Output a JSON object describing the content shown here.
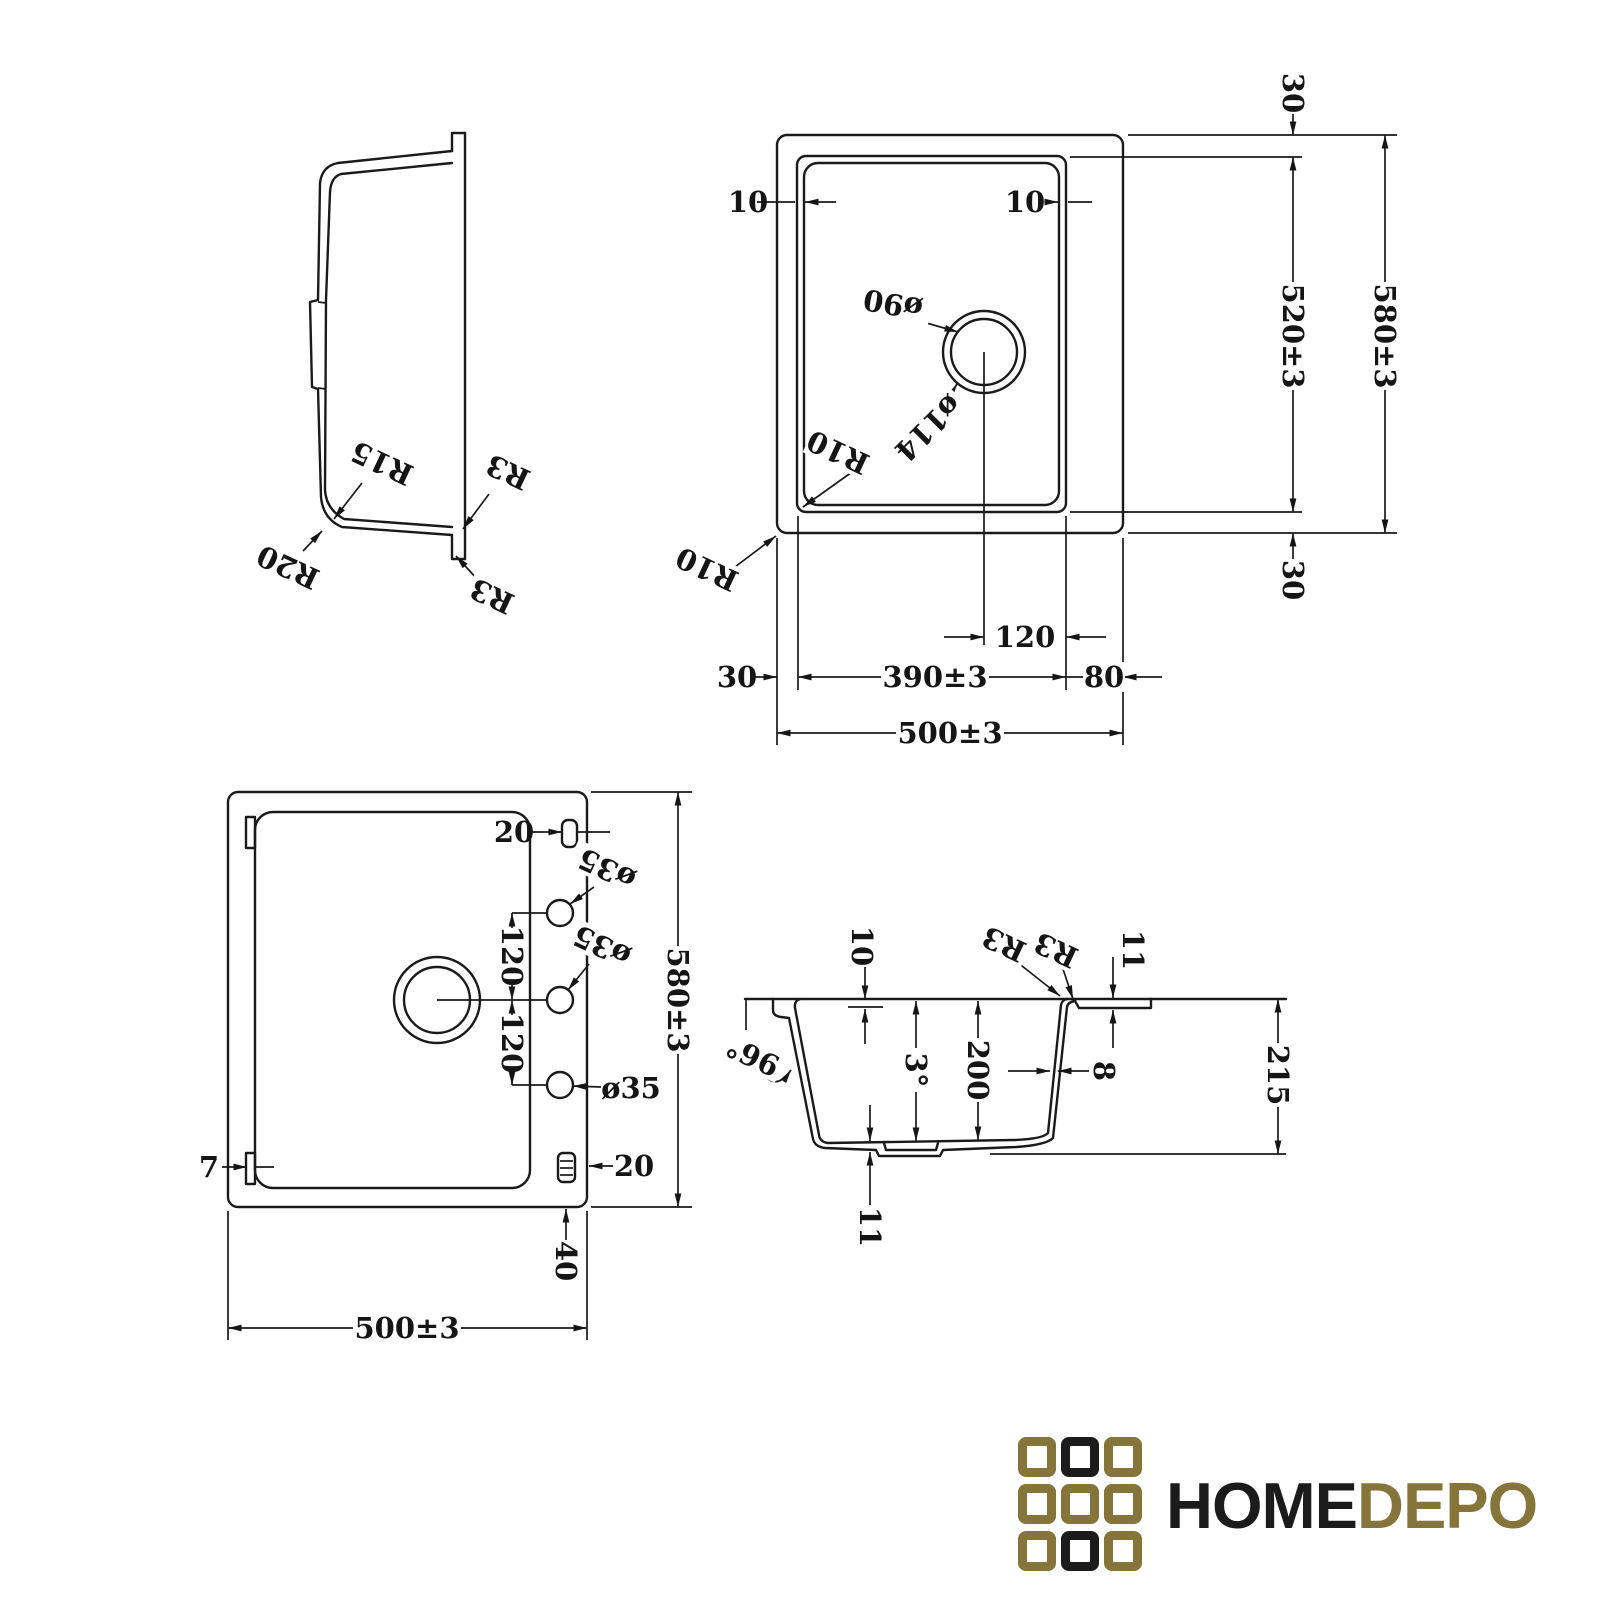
{
  "views": {
    "side_profile": {
      "labels": {
        "r15": "R15",
        "r20": "R20",
        "r3_top": "R3",
        "r3_bottom": "R3"
      }
    },
    "top": {
      "dims": {
        "lip_left": "10",
        "lip_right": "10",
        "drain_dia": "ø90",
        "flange_dia": "ø114",
        "r10_inner": "R10",
        "r10_outer": "R10",
        "rim_top": "30",
        "bowl_depth": "520±3",
        "overall_depth": "580±3",
        "rim_bottom": "30",
        "drain_offset": "120",
        "bowl_width": "390±3",
        "rim_right": "80",
        "rim_left": "30",
        "overall_width": "500±3"
      }
    },
    "bottom": {
      "dims": {
        "slot_top": "20",
        "tap_hole_top": "ø35",
        "tap_hole_mid": "ø35",
        "tap_hole_bottom": "ø35",
        "hole_pitch_1": "120",
        "hole_pitch_2": "120",
        "overall_depth": "580±3",
        "clip": "7",
        "slot_bottom": "20",
        "ledge": "40",
        "overall_width": "500±3"
      }
    },
    "section": {
      "dims": {
        "lip_drop": "10",
        "r3_outer": "R3",
        "r3_inner": "R3",
        "rim_thickness": "11",
        "wall_angle": "96°",
        "draft_angle": "3°",
        "bowl_depth": "200",
        "wall_thickness": "8",
        "overall_height": "215",
        "bottom_thickness": "11"
      }
    }
  },
  "logo": {
    "text_black": "HOME",
    "text_gold": "DEPO",
    "colors": {
      "gold": "#85753a",
      "black": "#1b1b1b"
    },
    "grid": [
      [
        "gold",
        "black",
        "gold"
      ],
      [
        "gold",
        "gold",
        "gold"
      ],
      [
        "gold",
        "black",
        "gold"
      ]
    ]
  }
}
